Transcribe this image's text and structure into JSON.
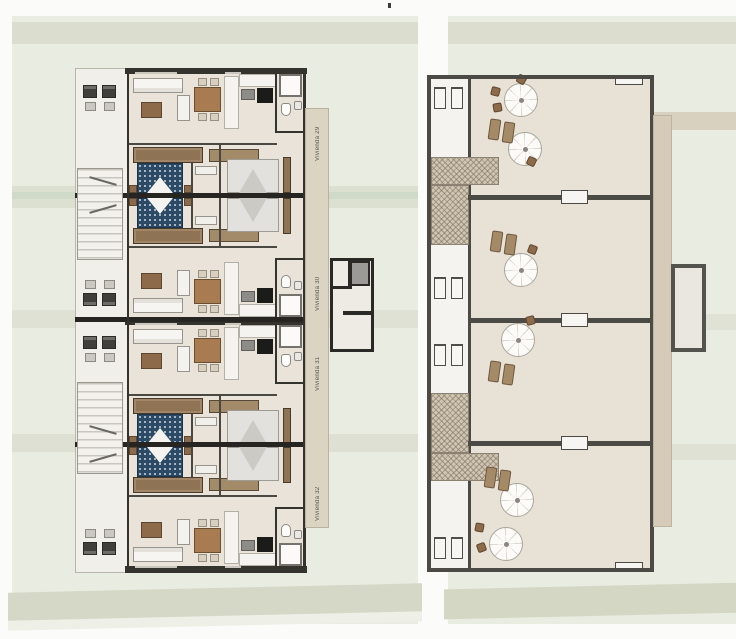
{
  "sheet": {
    "type": "architectural-plan-drawing",
    "left_sheet_name": "floor-plan",
    "right_sheet_name": "roof-solarium-plan"
  },
  "floor_plan": {
    "units": [
      {
        "id": "vivienda-29",
        "label": "Vivienda 29"
      },
      {
        "id": "vivienda-30",
        "label": "Vivienda 30"
      },
      {
        "id": "vivienda-31",
        "label": "Vivienda 31"
      },
      {
        "id": "vivienda-32",
        "label": "Vivienda 32"
      }
    ],
    "furniture_icons": [
      "sofa-icon",
      "coffee-table-icon",
      "armchair-icon",
      "dining-table-icon",
      "dining-chair-icon",
      "kitchen-counter",
      "fridge-icon",
      "cooktop-icon",
      "shower-icon",
      "toilet-icon",
      "sink-icon",
      "double-bed-blue-icon",
      "double-bed-white-icon",
      "nightstand-icon",
      "wardrobe-icon",
      "sun-lounger-icon",
      "balcony-armchair-icon",
      "balcony-table-icon",
      "stairs-icon",
      "elevator-icon",
      "window-icon"
    ]
  },
  "roof_plan": {
    "terraces": 4,
    "furniture_icons": [
      "parasol-icon",
      "patio-chair-icon",
      "sun-lounger-icon",
      "stairs-hatch-icon",
      "window-icon",
      "door-icon"
    ]
  },
  "colors": {
    "page_background": "#fbfcf9",
    "site_band": "#e9ece1",
    "site_band_dark": "#dbddcf",
    "site_band_green": "#cfdbc8",
    "floor_beige": "#e9e3d9",
    "roof_floor": "#e7e1d6",
    "wall_dark": "#35332e",
    "roof_wall": "#4b4a44",
    "label_strip": "#dcd4c3",
    "label_text": "#54524c",
    "bed_blue": "#2c4a66",
    "wood_brown": "#8d6a49",
    "lounger_brown": "#8f7355",
    "hatch_tan": "#cfc5b2"
  }
}
